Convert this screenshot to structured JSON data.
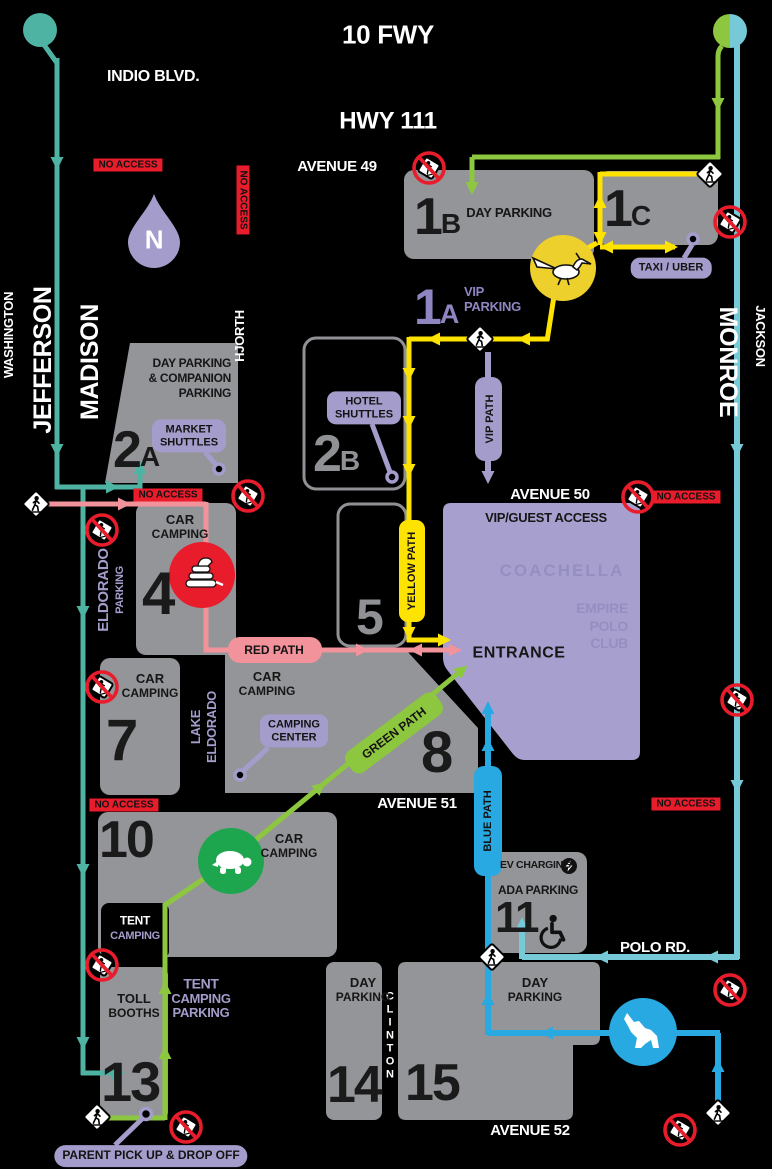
{
  "colors": {
    "teal": "#4fb3a3",
    "cyan": "#76cad8",
    "green": "#8dc63f",
    "turtle_green": "#1ea64f",
    "gold": "#edd02b",
    "yellow": "#ffe300",
    "pink": "#f2929b",
    "blue": "#29a9e1",
    "purple": "#a49dcb",
    "purple_dark": "#8e86c0",
    "lot_gray": "#949599",
    "red": "#e91c2c",
    "entrance_purple": "#a7a0ce"
  },
  "header": {
    "fwy": "10 FWY",
    "indio": "INDIO BLVD.",
    "hwy": "HWY 111"
  },
  "roads": {
    "ave49": "AVENUE 49",
    "ave50": "AVENUE 50",
    "ave51": "AVENUE 51",
    "ave52": "AVENUE 52",
    "polo": "POLO RD.",
    "washington": "WASHINGTON",
    "jefferson": "JEFFERSON",
    "madison": "MADISON",
    "hjorth": "HJORTH",
    "monroe": "MONROE",
    "jackson": "JACKSON",
    "clinton": "CLINTON",
    "eldorado": "ELDORADO",
    "eldorado_sub": "PARKING",
    "lake": "LAKE",
    "lake_sub": "ELDORADO"
  },
  "entrance": {
    "title": "ENTRANCE",
    "banner": "VIP/GUEST ACCESS",
    "wm1": "COACHELLA",
    "wm2": "EMPIRE",
    "wm3": "POLO",
    "wm4": "CLUB"
  },
  "lots": {
    "l1b": {
      "num": "1",
      "sub": "B",
      "w1": "DAY",
      "w2": "PARKING"
    },
    "l1c": {
      "num": "1",
      "sub": "C"
    },
    "l1a": {
      "num": "1",
      "sub": "A",
      "label1": "VIP",
      "label2": "PARKING"
    },
    "l2a": {
      "num": "2",
      "sub": "A",
      "line1": "DAY PARKING",
      "line2": "& COMPANION",
      "line3": "PARKING"
    },
    "l2b": {
      "num": "2",
      "sub": "B"
    },
    "l4": {
      "num": "4",
      "line1": "CAR",
      "line2": "CAMPING"
    },
    "l5": {
      "num": "5"
    },
    "l7": {
      "num": "7",
      "line1": "CAR",
      "line2": "CAMPING"
    },
    "l8": {
      "num": "8",
      "line1": "CAR",
      "line2": "CAMPING"
    },
    "l10": {
      "num": "10",
      "line1": "CAR",
      "line2": "CAMPING"
    },
    "l11": {
      "num": "11",
      "ev1": "EV",
      "ev2": "CHARGING",
      "ada": "ADA PARKING"
    },
    "l13": {
      "num": "13",
      "line1": "TOLL",
      "line2": "BOOTHS",
      "tent1": "TENT",
      "tent2": "CAMPING"
    },
    "l14": {
      "num": "14",
      "line1": "DAY",
      "line2": "PARKING"
    },
    "l15": {
      "num": "15",
      "line1": "DAY",
      "line2": "PARKING"
    }
  },
  "pills": {
    "market1": "MARKET",
    "market2": "SHUTTLES",
    "hotel1": "HOTEL",
    "hotel2": "SHUTTLES",
    "camping1": "CAMPING",
    "camping2": "CENTER",
    "taxi": "TAXI / UBER",
    "parent": "PARENT PICK UP & DROP OFF"
  },
  "path_labels": {
    "vip": "VIP PATH",
    "yellow": "YELLOW PATH",
    "red": "RED PATH",
    "green": "GREEN PATH",
    "blue": "BLUE PATH"
  },
  "tent_area": {
    "line1": "TENT",
    "line2": "CAMPING",
    "line3": "PARKING"
  },
  "badges": {
    "no_access": "NO ACCESS"
  },
  "compass": {
    "n": "N"
  },
  "icons": {
    "roadrunner": "roadrunner-marker",
    "snake": "rattlesnake-marker",
    "turtle": "turtle-marker",
    "coyote": "coyote-marker",
    "wheelchair": "ada-wheelchair",
    "bolt": "ev-lightning",
    "ped": "pedestrian-crossing",
    "noped": "no-pedestrian-access"
  }
}
